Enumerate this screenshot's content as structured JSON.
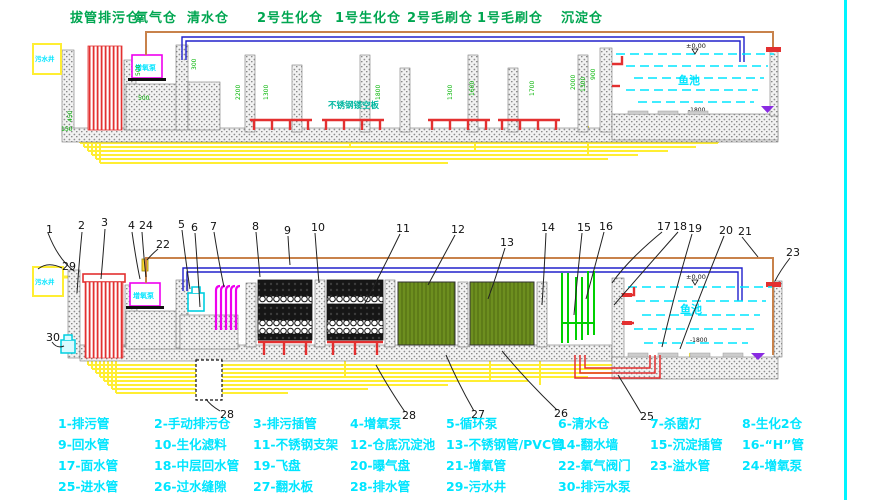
{
  "sheet": {
    "type": "工艺断面图",
    "border_color": "#00f5ff"
  },
  "chambers": [
    "拔管排污仓",
    "氧气仓",
    "清水仓",
    "2号生化仓",
    "1号生化仓",
    "2号毛刷仓",
    "1号毛刷仓",
    "沉淀仓"
  ],
  "legend": {
    "items": [
      "1-排污管",
      "2-手动排污仓",
      "3-排污插管",
      "4-增氧泵",
      "5-循环泵",
      "6-清水仓",
      "7-杀菌灯",
      "8-生化2仓",
      "9-回水管",
      "10-生化滤料",
      "11-不锈钢支架",
      "12-仓底沉淀池",
      "13-不锈钢管/PVC管",
      "14-翻水墙",
      "15-沉淀插管",
      "16-“H”管",
      "17-面水管",
      "18-中层回水管",
      "19-飞盘",
      "20-曝气盘",
      "21-增氧管",
      "22-氧气阀门",
      "23-溢水管",
      "24-增氧泵",
      "25-进水管",
      "26-过水缝隙",
      "27-翻水板",
      "28-排水管",
      "29-污水井",
      "30-排污水泵"
    ]
  },
  "callouts": [
    "1",
    "2",
    "3",
    "4",
    "24",
    "22",
    "29",
    "5",
    "6",
    "7",
    "8",
    "9",
    "10",
    "11",
    "12",
    "13",
    "14",
    "15",
    "16",
    "17",
    "18",
    "19",
    "20",
    "21",
    "23",
    "30",
    "28",
    "28",
    "27",
    "26",
    "25"
  ],
  "ann": {
    "well": "污水井",
    "aerator": "增氧泵",
    "pond": "鱼池",
    "level_top": "±0.00",
    "level_bottom": "-1800",
    "plate": "不锈钢镂空板"
  },
  "dims": {
    "top": [
      "500",
      "500",
      "300",
      "2200",
      "1300",
      "1800",
      "1300",
      "1600",
      "1700",
      "2000",
      "1300",
      "900",
      "450",
      "150"
    ]
  },
  "colors": {
    "legend_cyan": "#00e5ff",
    "chamber_green": "#00a651",
    "dim_green": "#00b400",
    "pipe_yellow": "#ffee33",
    "pipe_red": "#e33030",
    "pipe_blue": "#2020cc",
    "pipe_brown": "#c8824b",
    "pipe_magenta": "#ee00ee",
    "brush_green": "#6d8f1f",
    "water_cyan": "#00e5ff",
    "marker_purple": "#8a2be2"
  }
}
